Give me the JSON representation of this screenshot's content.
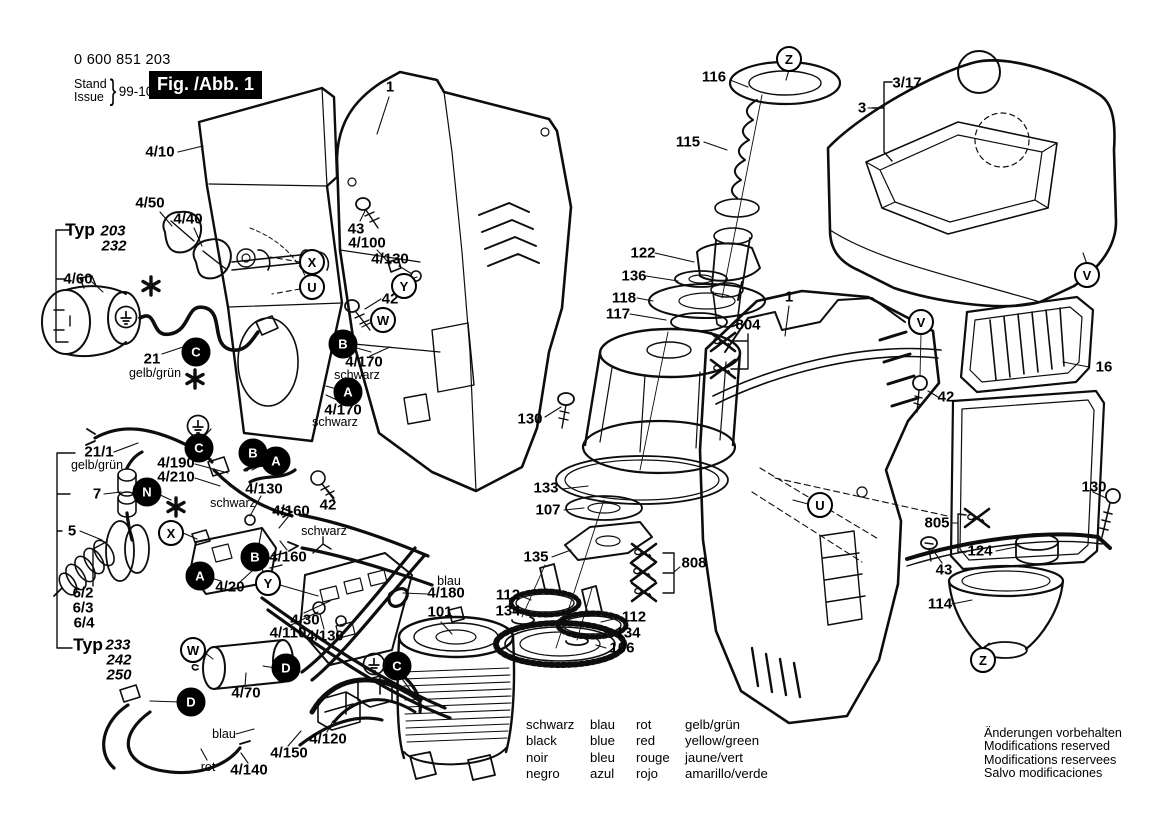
{
  "header": {
    "part_number": "0 600 851 203",
    "stand": "Stand",
    "issue": "Issue",
    "date": "99-10-07",
    "figure": "Fig. /Abb. 1"
  },
  "legend": {
    "rows": [
      [
        "schwarz",
        "blau",
        "rot",
        "gelb/grün"
      ],
      [
        "black",
        "blue",
        "red",
        "yellow/green"
      ],
      [
        "noir",
        "bleu",
        "rouge",
        "jaune/vert"
      ],
      [
        "negro",
        "azul",
        "rojo",
        "amarillo/verde"
      ]
    ]
  },
  "notice": {
    "lines": [
      "Änderungen vorbehalten",
      "Modifications reserved",
      "Modifications reservees",
      "Salvo modificaciones"
    ]
  },
  "colors": {
    "line": "#0d0d0d",
    "background": "#ffffff",
    "figure_box": "#000000"
  },
  "callouts": [
    {
      "text": "1",
      "x": 390,
      "y": 87,
      "cls": ""
    },
    {
      "text": "4/10",
      "x": 160,
      "y": 152,
      "cls": ""
    },
    {
      "text": "4/50",
      "x": 150,
      "y": 203,
      "cls": ""
    },
    {
      "text": "4/40",
      "x": 188,
      "y": 219,
      "cls": ""
    },
    {
      "text": "Typ",
      "x": 80,
      "y": 230,
      "cls": "typ"
    },
    {
      "text": "203",
      "x": 113,
      "y": 231,
      "cls": "mdl"
    },
    {
      "text": "232",
      "x": 114,
      "y": 246,
      "cls": "mdl"
    },
    {
      "text": "4/60",
      "x": 78,
      "y": 279,
      "cls": ""
    },
    {
      "text": "21",
      "x": 152,
      "y": 359,
      "cls": ""
    },
    {
      "text": "gelb/grün",
      "x": 155,
      "y": 373,
      "cls": "sub"
    },
    {
      "text": "43",
      "x": 356,
      "y": 229,
      "cls": ""
    },
    {
      "text": "4/100",
      "x": 367,
      "y": 243,
      "cls": ""
    },
    {
      "text": "4/130",
      "x": 390,
      "y": 259,
      "cls": ""
    },
    {
      "text": "42",
      "x": 390,
      "y": 299,
      "cls": ""
    },
    {
      "text": "4/170",
      "x": 364,
      "y": 362,
      "cls": ""
    },
    {
      "text": "schwarz",
      "x": 357,
      "y": 375,
      "cls": "sub"
    },
    {
      "text": "4/170",
      "x": 343,
      "y": 410,
      "cls": ""
    },
    {
      "text": "schwarz",
      "x": 335,
      "y": 422,
      "cls": "sub"
    },
    {
      "text": "116",
      "x": 714,
      "y": 77,
      "cls": ""
    },
    {
      "text": "115",
      "x": 688,
      "y": 142,
      "cls": ""
    },
    {
      "text": "3",
      "x": 862,
      "y": 108,
      "cls": ""
    },
    {
      "text": "3/17",
      "x": 907,
      "y": 83,
      "cls": ""
    },
    {
      "text": "122",
      "x": 643,
      "y": 253,
      "cls": ""
    },
    {
      "text": "136",
      "x": 634,
      "y": 276,
      "cls": ""
    },
    {
      "text": "118",
      "x": 624,
      "y": 298,
      "cls": ""
    },
    {
      "text": "117",
      "x": 618,
      "y": 314,
      "cls": ""
    },
    {
      "text": "804",
      "x": 748,
      "y": 325,
      "cls": ""
    },
    {
      "text": "1",
      "x": 789,
      "y": 297,
      "cls": ""
    },
    {
      "text": "16",
      "x": 1104,
      "y": 367,
      "cls": ""
    },
    {
      "text": "42",
      "x": 946,
      "y": 397,
      "cls": ""
    },
    {
      "text": "130",
      "x": 1094,
      "y": 487,
      "cls": ""
    },
    {
      "text": "805",
      "x": 937,
      "y": 523,
      "cls": ""
    },
    {
      "text": "124",
      "x": 980,
      "y": 551,
      "cls": ""
    },
    {
      "text": "43",
      "x": 944,
      "y": 570,
      "cls": ""
    },
    {
      "text": "114",
      "x": 940,
      "y": 604,
      "cls": ""
    },
    {
      "text": "130",
      "x": 530,
      "y": 419,
      "cls": ""
    },
    {
      "text": "133",
      "x": 546,
      "y": 488,
      "cls": ""
    },
    {
      "text": "107",
      "x": 548,
      "y": 510,
      "cls": ""
    },
    {
      "text": "135",
      "x": 536,
      "y": 557,
      "cls": ""
    },
    {
      "text": "808",
      "x": 694,
      "y": 563,
      "cls": ""
    },
    {
      "text": "112",
      "x": 508,
      "y": 595,
      "cls": ""
    },
    {
      "text": "134",
      "x": 508,
      "y": 611,
      "cls": ""
    },
    {
      "text": "112",
      "x": 634,
      "y": 617,
      "cls": ""
    },
    {
      "text": "134",
      "x": 628,
      "y": 633,
      "cls": ""
    },
    {
      "text": "106",
      "x": 622,
      "y": 648,
      "cls": ""
    },
    {
      "text": "blau",
      "x": 449,
      "y": 581,
      "cls": "sub"
    },
    {
      "text": "4/180",
      "x": 446,
      "y": 593,
      "cls": ""
    },
    {
      "text": "101",
      "x": 440,
      "y": 612,
      "cls": ""
    },
    {
      "text": "21/1",
      "x": 99,
      "y": 452,
      "cls": ""
    },
    {
      "text": "gelb/grün",
      "x": 97,
      "y": 465,
      "cls": "sub"
    },
    {
      "text": "7",
      "x": 97,
      "y": 494,
      "cls": ""
    },
    {
      "text": "5",
      "x": 72,
      "y": 531,
      "cls": ""
    },
    {
      "text": "6/2",
      "x": 83,
      "y": 593,
      "cls": ""
    },
    {
      "text": "6/3",
      "x": 83,
      "y": 608,
      "cls": ""
    },
    {
      "text": "6/4",
      "x": 84,
      "y": 623,
      "cls": ""
    },
    {
      "text": "Typ",
      "x": 88,
      "y": 645,
      "cls": "typ"
    },
    {
      "text": "233",
      "x": 118,
      "y": 645,
      "cls": "mdl"
    },
    {
      "text": "242",
      "x": 119,
      "y": 660,
      "cls": "mdl"
    },
    {
      "text": "250",
      "x": 119,
      "y": 675,
      "cls": "mdl"
    },
    {
      "text": "4/190",
      "x": 176,
      "y": 463,
      "cls": ""
    },
    {
      "text": "4/210",
      "x": 176,
      "y": 477,
      "cls": ""
    },
    {
      "text": "schwarz",
      "x": 233,
      "y": 503,
      "cls": "sub"
    },
    {
      "text": "4/130",
      "x": 264,
      "y": 489,
      "cls": ""
    },
    {
      "text": "4/160",
      "x": 291,
      "y": 511,
      "cls": ""
    },
    {
      "text": "schwarz",
      "x": 324,
      "y": 531,
      "cls": "sub"
    },
    {
      "text": "4/160",
      "x": 288,
      "y": 557,
      "cls": ""
    },
    {
      "text": "42",
      "x": 328,
      "y": 505,
      "cls": ""
    },
    {
      "text": "4/20",
      "x": 230,
      "y": 587,
      "cls": ""
    },
    {
      "text": "4/30",
      "x": 305,
      "y": 620,
      "cls": ""
    },
    {
      "text": "4/110",
      "x": 288,
      "y": 633,
      "cls": ""
    },
    {
      "text": "4/130",
      "x": 325,
      "y": 636,
      "cls": ""
    },
    {
      "text": "4/70",
      "x": 246,
      "y": 693,
      "cls": ""
    },
    {
      "text": "blau",
      "x": 224,
      "y": 734,
      "cls": "sub"
    },
    {
      "text": "4/120",
      "x": 328,
      "y": 739,
      "cls": ""
    },
    {
      "text": "4/150",
      "x": 289,
      "y": 753,
      "cls": ""
    },
    {
      "text": "rot",
      "x": 208,
      "y": 767,
      "cls": "sub"
    },
    {
      "text": "4/140",
      "x": 249,
      "y": 770,
      "cls": ""
    }
  ],
  "markers": [
    {
      "letter": "X",
      "x": 312,
      "y": 262,
      "filled": false
    },
    {
      "letter": "U",
      "x": 312,
      "y": 287,
      "filled": false
    },
    {
      "letter": "Y",
      "x": 404,
      "y": 286,
      "filled": false
    },
    {
      "letter": "W",
      "x": 383,
      "y": 320,
      "filled": false
    },
    {
      "letter": "B",
      "x": 343,
      "y": 344,
      "filled": true
    },
    {
      "letter": "A",
      "x": 348,
      "y": 392,
      "filled": true
    },
    {
      "letter": "C",
      "x": 196,
      "y": 352,
      "filled": true
    },
    {
      "letter": "Z",
      "x": 789,
      "y": 59,
      "filled": false
    },
    {
      "letter": "V",
      "x": 1087,
      "y": 275,
      "filled": false
    },
    {
      "letter": "V",
      "x": 921,
      "y": 322,
      "filled": false
    },
    {
      "letter": "U",
      "x": 820,
      "y": 505,
      "filled": false
    },
    {
      "letter": "Z",
      "x": 983,
      "y": 660,
      "filled": false
    },
    {
      "letter": "C",
      "x": 199,
      "y": 448,
      "filled": true
    },
    {
      "letter": "N",
      "x": 147,
      "y": 492,
      "filled": true
    },
    {
      "letter": "B",
      "x": 253,
      "y": 453,
      "filled": true
    },
    {
      "letter": "A",
      "x": 276,
      "y": 461,
      "filled": true
    },
    {
      "letter": "X",
      "x": 171,
      "y": 533,
      "filled": false
    },
    {
      "letter": "B",
      "x": 255,
      "y": 557,
      "filled": true
    },
    {
      "letter": "A",
      "x": 200,
      "y": 576,
      "filled": true
    },
    {
      "letter": "Y",
      "x": 268,
      "y": 583,
      "filled": false
    },
    {
      "letter": "W",
      "x": 193,
      "y": 650,
      "filled": false
    },
    {
      "letter": "D",
      "x": 286,
      "y": 668,
      "filled": true
    },
    {
      "letter": "C",
      "x": 397,
      "y": 666,
      "filled": true
    },
    {
      "letter": "D",
      "x": 191,
      "y": 702,
      "filled": true
    }
  ],
  "symbols": [
    {
      "type": "star",
      "x": 151,
      "y": 286
    },
    {
      "type": "star",
      "x": 195,
      "y": 379
    },
    {
      "type": "star",
      "x": 176,
      "y": 507
    },
    {
      "type": "ground",
      "x": 126,
      "y": 317
    },
    {
      "type": "ground",
      "x": 198,
      "y": 426
    },
    {
      "type": "ground",
      "x": 374,
      "y": 664
    },
    {
      "type": "crossed-screw",
      "x": 723,
      "y": 342
    },
    {
      "type": "crossed-screw",
      "x": 723,
      "y": 369
    },
    {
      "type": "crossed-screw",
      "x": 644,
      "y": 553
    },
    {
      "type": "crossed-screw",
      "x": 643,
      "y": 572
    },
    {
      "type": "crossed-screw",
      "x": 644,
      "y": 592
    },
    {
      "type": "crossed-screw",
      "x": 977,
      "y": 518
    }
  ]
}
